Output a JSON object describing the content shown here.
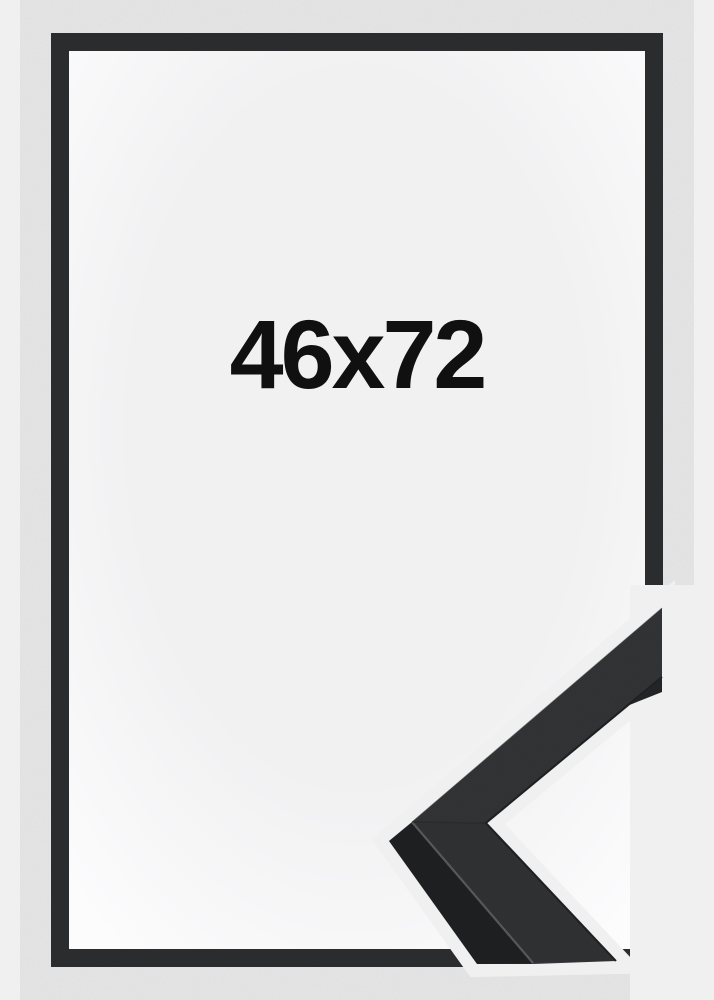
{
  "page": {
    "background_color": "#f0f0f1"
  },
  "frame_preview": {
    "size_label": "46x72",
    "frame_color": "#2d2f31",
    "interior_center_color": "#f1f1f2",
    "interior_edge_color": "#fcfcfd"
  },
  "corner_sample": {
    "face_upper_color": "#3d3f42",
    "face_lower_color": "#3a3c3f",
    "side_color": "#26272a",
    "edge_highlight_color": "#6b6d70",
    "inner_edge_color": "#232427",
    "outer_edge_color": "#4b4d50",
    "seam_color": "#2f3134"
  }
}
